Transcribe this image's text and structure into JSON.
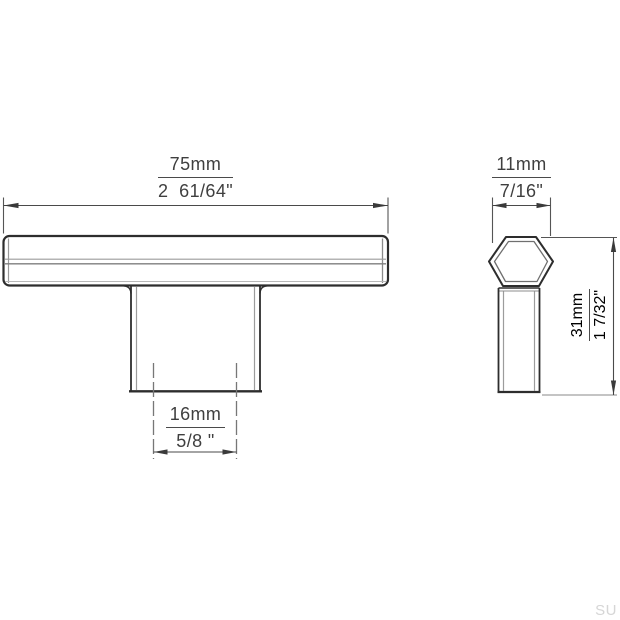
{
  "page": {
    "background": "#ffffff",
    "watermark": "SU"
  },
  "drawing": {
    "title": "T-bar knob technical drawing, front and side views",
    "colors": {
      "outline": "#2d2d2d",
      "secondary_line": "#9c9c9c",
      "dimension_line": "#4a4a4a",
      "text": "#3f3f3f",
      "watermark": "#d6d6d6"
    },
    "front_view": {
      "width": {
        "mm": "75mm",
        "inch": "2  61/64\""
      },
      "base_width": {
        "mm": "16mm",
        "inch": "5/8 \""
      }
    },
    "side_view": {
      "depth": {
        "mm": "11mm",
        "inch": "7/16\""
      },
      "height": {
        "mm": "31mm",
        "inch": "1 7/32\""
      }
    }
  }
}
